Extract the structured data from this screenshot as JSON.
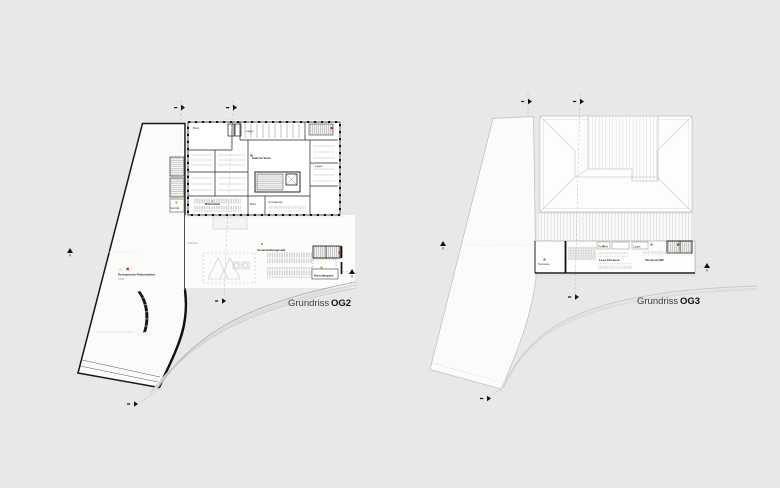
{
  "document": {
    "type": "architectural floor plan sheet",
    "background": "#e8e8e7"
  },
  "colors": {
    "background": "#e8e8e7",
    "plan_fill": "#fbfbfa",
    "line_dark": "#161616",
    "line_light": "#c8c8c6",
    "accent_red": "#b03028",
    "accent_yellow": "#c3a42e",
    "accent_blue": "#5b7fb3",
    "accent_green": "#4e8a4e",
    "caption_text": "#3c3c3c"
  },
  "og2": {
    "caption": {
      "regular": "Grundriss",
      "bold": "OG2"
    },
    "rooms": {
      "buero_tl": "Büro",
      "lager_top": "Lager",
      "galerie": "Galerie Verw.",
      "lager_right": "Lager",
      "bibliothek": "Bibliothek",
      "buero_unten": "Büro",
      "sozialraum": "Sozialraum",
      "sanitaet": "Sanität",
      "veranstaltung": "Veranstaltungssaal",
      "kuenstler": "Künstlergard.",
      "luftraum": "Luftraum",
      "permanente": "Permanente Präsentation",
      "permanente_area": "2166",
      "permanente_no": "01"
    }
  },
  "og3": {
    "caption": {
      "regular": "Grundriss",
      "bold": "OG3"
    },
    "rooms": {
      "terrasse": "Terrasse",
      "technik": "Technik",
      "lager": "Lager",
      "lese": "Lese Terrasse",
      "terrasse_nw": "Terrasse NW"
    }
  }
}
